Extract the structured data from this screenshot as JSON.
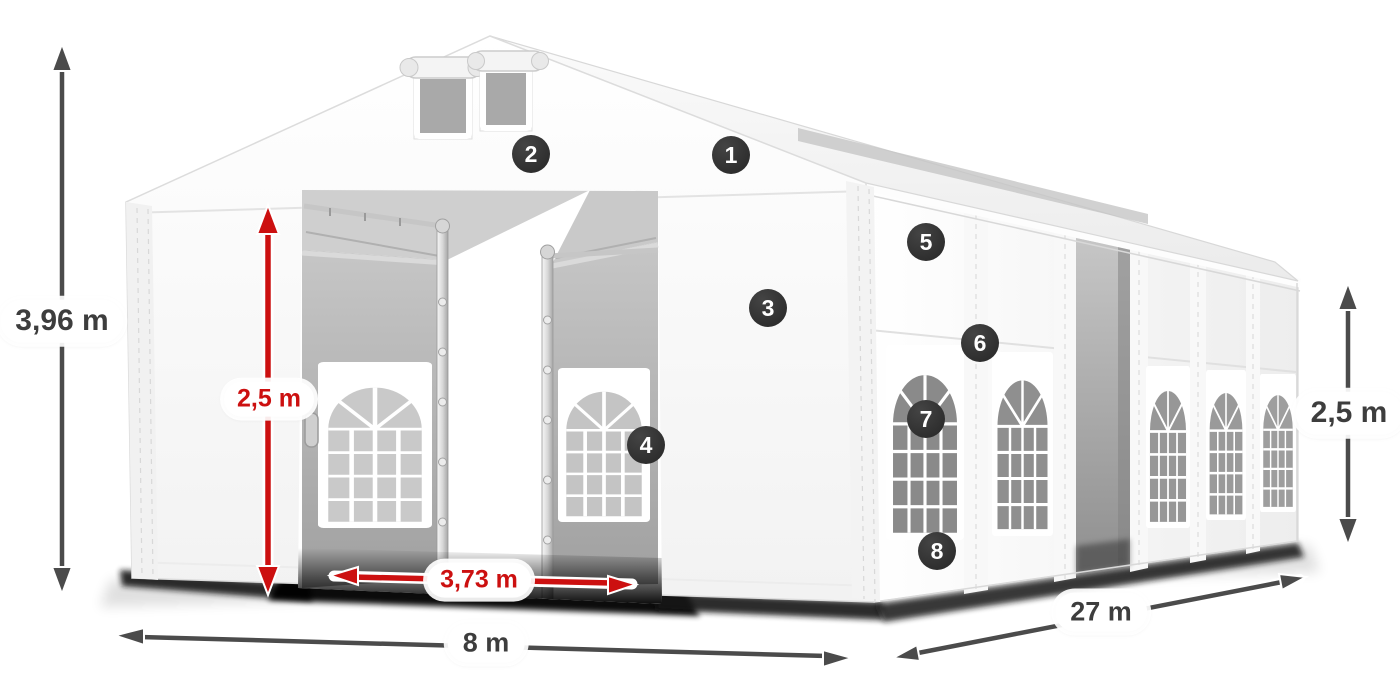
{
  "dimensions": {
    "total_height": {
      "value": "3,96 m",
      "style": "gray",
      "orientation": "vertical-left"
    },
    "entrance_height": {
      "value": "2,5 m",
      "style": "red",
      "orientation": "vertical-entrance"
    },
    "entrance_width": {
      "value": "3,73 m",
      "style": "red",
      "orientation": "horizontal-entrance"
    },
    "front_width": {
      "value": "8 m",
      "style": "gray",
      "orientation": "horizontal-front"
    },
    "side_length": {
      "value": "27 m",
      "style": "gray",
      "orientation": "diagonal-side"
    },
    "wall_height": {
      "value": "2,5 m",
      "style": "gray",
      "orientation": "vertical-right"
    }
  },
  "callouts": {
    "labels": [
      "1",
      "2",
      "3",
      "4",
      "5",
      "6",
      "7",
      "8"
    ]
  },
  "colors": {
    "background": "#ffffff",
    "tent_white": "#ffffff",
    "dimension_red": "#cc1010",
    "dimension_arrow_gray": "#4b4b4b",
    "label_text_dark": "#3d3d3d",
    "badge_background": "#2b2b2b",
    "badge_text": "#ffffff",
    "ground_shadow": "#111111"
  }
}
